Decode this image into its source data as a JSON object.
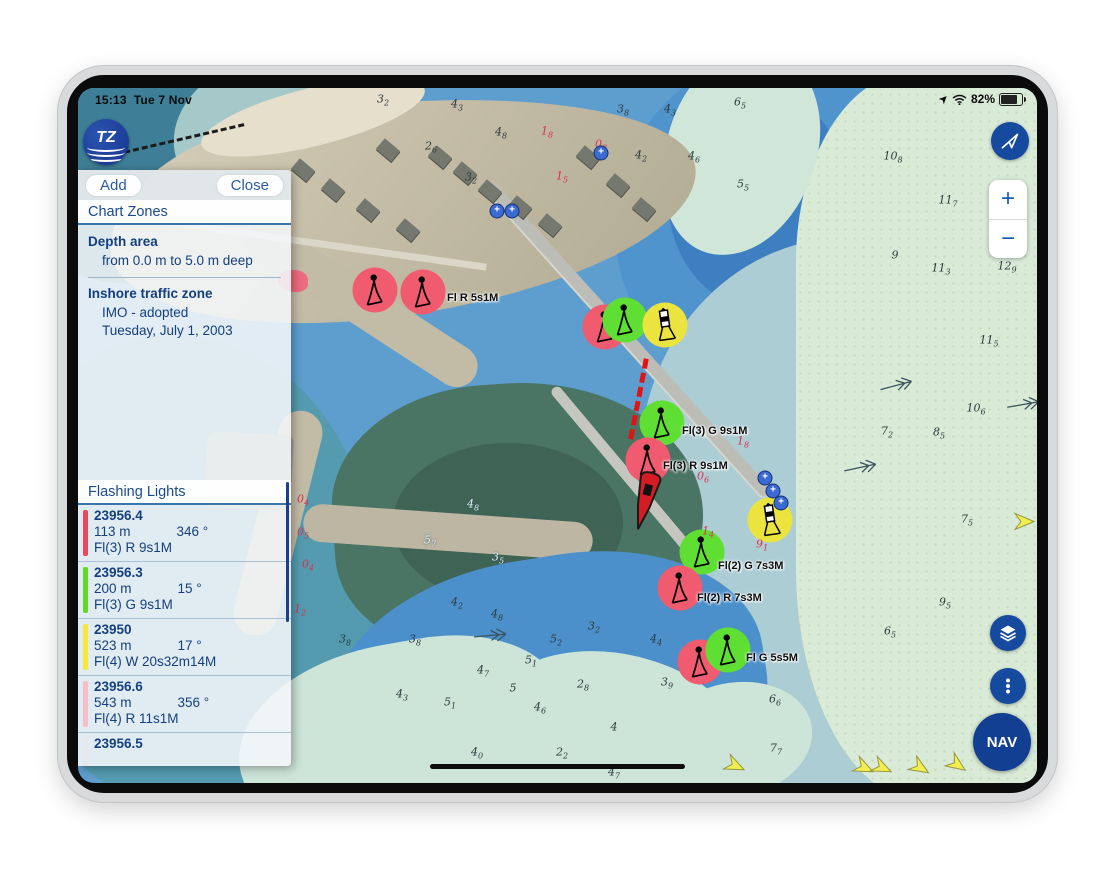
{
  "status_bar": {
    "time": "15:13",
    "date": "Tue 7 Nov",
    "battery_percent": "82%"
  },
  "logo": {
    "label": "TZ"
  },
  "panel": {
    "add_label": "Add",
    "close_label": "Close",
    "chart_zones": {
      "title": "Chart Zones",
      "sections": [
        {
          "heading": "Depth area",
          "lines": [
            "from 0.0 m to 5.0 m deep"
          ]
        },
        {
          "heading": "Inshore traffic zone",
          "lines": [
            "IMO - adopted",
            "Tuesday, July 1, 2003"
          ]
        }
      ]
    },
    "flashing_lights": {
      "title": "Flashing Lights",
      "items": [
        {
          "id": "23956.4",
          "distance": "113 m",
          "bearing": "346 °",
          "characteristic": "Fl(3) R 9s1M",
          "bar_color": "#e8495d"
        },
        {
          "id": "23956.3",
          "distance": "200 m",
          "bearing": "15 °",
          "characteristic": "Fl(3) G 9s1M",
          "bar_color": "#61d926"
        },
        {
          "id": "23950",
          "distance": "523 m",
          "bearing": "17 °",
          "characteristic": "Fl(4) W 20s32m14M",
          "bar_color": "#f4e838"
        },
        {
          "id": "23956.6",
          "distance": "543 m",
          "bearing": "356 °",
          "characteristic": "Fl(4) R 11s1M",
          "bar_color": "#f4bfc8"
        },
        {
          "id": "23956.5",
          "distance": "",
          "bearing": "",
          "characteristic": "",
          "bar_color": "#e6e9ec"
        }
      ]
    }
  },
  "controls": {
    "zoom_in": "+",
    "zoom_out": "−",
    "nav_label": "NAV"
  },
  "map": {
    "light_fill": {
      "R": "#f05b6f",
      "G": "#5fdf33",
      "Y": "#ece43e"
    },
    "lights": [
      {
        "x": 297,
        "y": 202,
        "c": "R",
        "g": "flare"
      },
      {
        "x": 345,
        "y": 204,
        "c": "R",
        "g": "flare",
        "label": "Fl R 5s1M",
        "lx": 24,
        "ly": 0
      },
      {
        "x": 527,
        "y": 239,
        "c": "R",
        "g": "flare"
      },
      {
        "x": 547,
        "y": 232,
        "c": "G",
        "g": "flare"
      },
      {
        "x": 587,
        "y": 237,
        "c": "Y",
        "g": "tower"
      },
      {
        "x": 584,
        "y": 335,
        "c": "G",
        "g": "flare",
        "label": "Fl(3) G 9s1M",
        "lx": 20,
        "ly": 2
      },
      {
        "x": 570,
        "y": 372,
        "c": "R",
        "g": "flare",
        "label": "Fl(3) R 9s1M",
        "lx": 15,
        "ly": 0
      },
      {
        "x": 692,
        "y": 432,
        "c": "Y",
        "g": "tower"
      },
      {
        "x": 624,
        "y": 464,
        "c": "G",
        "g": "flare",
        "label": "Fl(2) G 7s3M",
        "lx": 16,
        "ly": 8
      },
      {
        "x": 602,
        "y": 500,
        "c": "R",
        "g": "flare",
        "label": "Fl(2) R 7s3M",
        "lx": 17,
        "ly": 4
      },
      {
        "x": 622,
        "y": 574,
        "c": "R",
        "g": "flare"
      },
      {
        "x": 650,
        "y": 562,
        "c": "G",
        "g": "flare",
        "label": "Fl G 5s5M",
        "lx": 18,
        "ly": 2
      }
    ],
    "depths": [
      [
        305,
        12,
        "3",
        "2",
        "k"
      ],
      [
        379,
        17,
        "4",
        "3",
        "k"
      ],
      [
        545,
        22,
        "3",
        "8",
        "k"
      ],
      [
        592,
        22,
        "4",
        "3",
        "k"
      ],
      [
        423,
        45,
        "4",
        "8",
        "k"
      ],
      [
        353,
        59,
        "2",
        "6",
        "k"
      ],
      [
        393,
        90,
        "3",
        "2",
        "k"
      ],
      [
        563,
        68,
        "4",
        "2",
        "k"
      ],
      [
        616,
        69,
        "4",
        "6",
        "k"
      ],
      [
        469,
        44,
        "1",
        "8",
        "r"
      ],
      [
        523,
        57,
        "0",
        "8",
        "r"
      ],
      [
        484,
        89,
        "1",
        "5",
        "r"
      ],
      [
        662,
        15,
        "6",
        "5",
        "k"
      ],
      [
        665,
        97,
        "5",
        "5",
        "k"
      ],
      [
        815,
        69,
        "10",
        "8",
        "k"
      ],
      [
        870,
        113,
        "11",
        "7",
        "k"
      ],
      [
        863,
        181,
        "11",
        "3",
        "k"
      ],
      [
        929,
        179,
        "12",
        "9",
        "k"
      ],
      [
        817,
        167,
        "9",
        "",
        "k"
      ],
      [
        911,
        253,
        "11",
        "5",
        "k"
      ],
      [
        809,
        344,
        "7",
        "2",
        "k"
      ],
      [
        861,
        345,
        "8",
        "5",
        "k"
      ],
      [
        898,
        321,
        "10",
        "6",
        "k"
      ],
      [
        889,
        432,
        "7",
        "5",
        "k"
      ],
      [
        867,
        515,
        "9",
        "5",
        "k"
      ],
      [
        812,
        544,
        "6",
        "5",
        "k"
      ],
      [
        665,
        354,
        "1",
        "8",
        "r"
      ],
      [
        625,
        389,
        "0",
        "6",
        "r"
      ],
      [
        630,
        444,
        "1",
        "4",
        "r"
      ],
      [
        684,
        457,
        "9",
        "1",
        "r"
      ],
      [
        379,
        515,
        "4",
        "2",
        "k"
      ],
      [
        419,
        527,
        "4",
        "8",
        "k"
      ],
      [
        337,
        552,
        "3",
        "8",
        "k"
      ],
      [
        478,
        552,
        "5",
        "2",
        "k"
      ],
      [
        516,
        539,
        "3",
        "2",
        "k"
      ],
      [
        578,
        552,
        "4",
        "4",
        "k"
      ],
      [
        453,
        573,
        "5",
        "1",
        "k"
      ],
      [
        405,
        583,
        "4",
        "7",
        "k"
      ],
      [
        435,
        600,
        "5",
        "",
        "k"
      ],
      [
        505,
        597,
        "2",
        "8",
        "k"
      ],
      [
        589,
        595,
        "3",
        "9",
        "k"
      ],
      [
        324,
        607,
        "4",
        "3",
        "k"
      ],
      [
        372,
        615,
        "5",
        "1",
        "k"
      ],
      [
        462,
        620,
        "4",
        "6",
        "k"
      ],
      [
        536,
        639,
        "4",
        "",
        "k"
      ],
      [
        399,
        665,
        "4",
        "0",
        "k"
      ],
      [
        484,
        665,
        "2",
        "2",
        "k"
      ],
      [
        536,
        685,
        "4",
        "7",
        "k"
      ],
      [
        697,
        612,
        "6",
        "6",
        "k"
      ],
      [
        698,
        661,
        "7",
        "7",
        "k"
      ],
      [
        225,
        412,
        "0",
        "4",
        "r"
      ],
      [
        225,
        445,
        "0",
        "5",
        "r"
      ],
      [
        230,
        477,
        "0",
        "4",
        "r"
      ],
      [
        222,
        522,
        "1",
        "2",
        "r"
      ],
      [
        352,
        453,
        "5",
        "7",
        "w"
      ],
      [
        395,
        417,
        "4",
        "8",
        "w"
      ],
      [
        420,
        470,
        "3",
        "5",
        "w"
      ],
      [
        267,
        552,
        "3",
        "8",
        "k"
      ]
    ],
    "buoys": [
      [
        523,
        65
      ],
      [
        419,
        123
      ],
      [
        434,
        123
      ],
      [
        687,
        390
      ],
      [
        695,
        403
      ],
      [
        703,
        415
      ]
    ],
    "current_arrows": [
      [
        657,
        680,
        205
      ],
      [
        786,
        682,
        205
      ],
      [
        804,
        682,
        205
      ],
      [
        842,
        682,
        212
      ],
      [
        879,
        679,
        215
      ],
      [
        946,
        436,
        180
      ]
    ],
    "stream_arrows": [
      [
        818,
        300,
        -15
      ],
      [
        945,
        319,
        -10
      ],
      [
        412,
        550,
        -5
      ],
      [
        782,
        382,
        -12
      ]
    ]
  }
}
